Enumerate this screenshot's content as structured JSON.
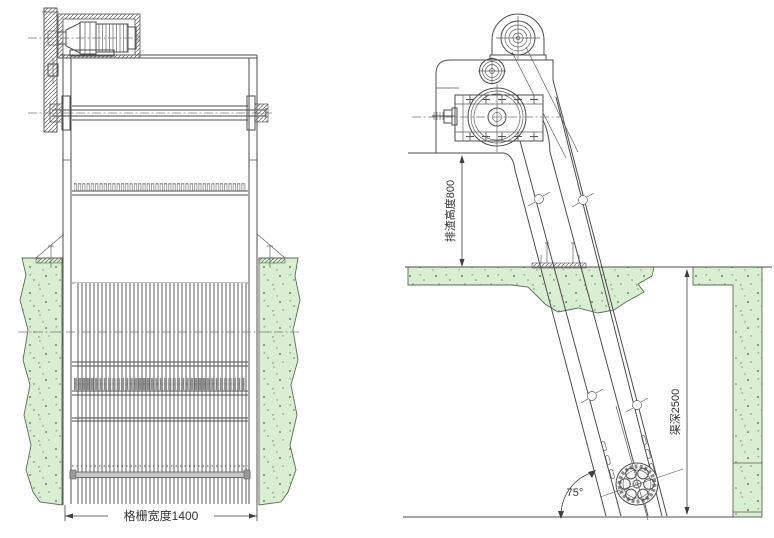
{
  "drawing": {
    "type": "mechanical-bar-screen-two-view-drawing",
    "front_view": {
      "grating_width_dimension": "格栅宽度1400"
    },
    "side_view": {
      "discharge_height_dimension": "排渣高度800",
      "channel_depth_dimension": "渠深2500",
      "incline_angle": "75°"
    }
  },
  "colors": {
    "concrete_green": "#d9eed2",
    "speckle": "#82957c",
    "line": "#4d4d4d",
    "background": "#ffffff"
  }
}
